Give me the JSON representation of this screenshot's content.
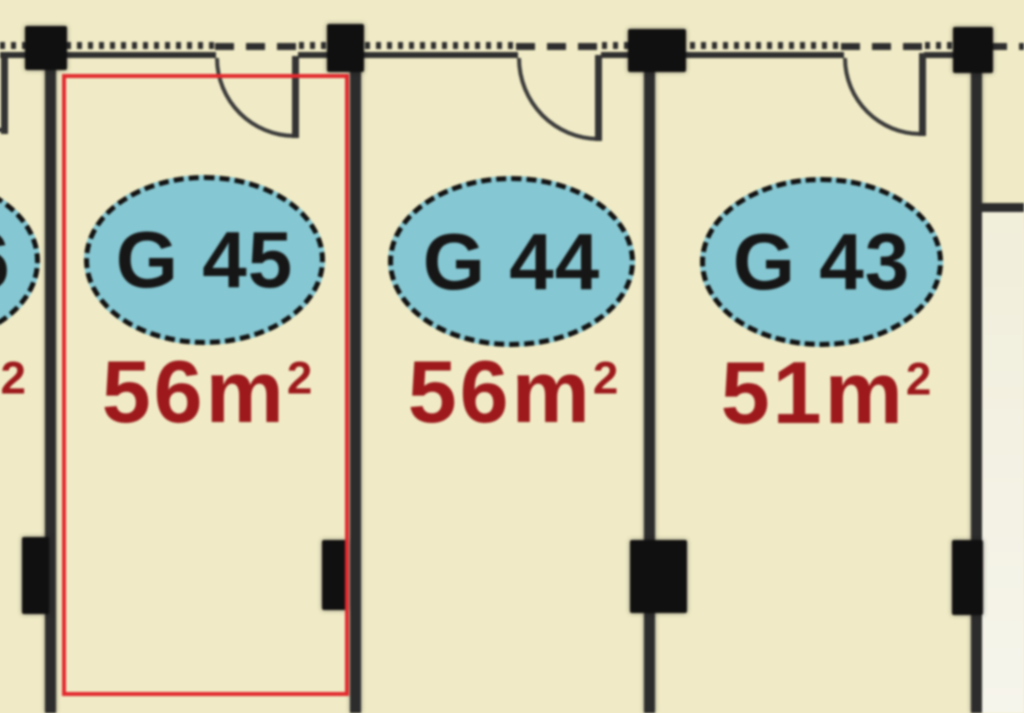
{
  "plan": {
    "title": "floor-plan-units",
    "colors": {
      "background": "#f0ebc6",
      "wall": "#2c2c2c",
      "column": "#101010",
      "ellipse_fill": "#85c7d2",
      "ellipse_border": "#121212",
      "unit_label_text": "#161616",
      "area_text": "#9d191c",
      "highlight_outline": "#e2292e"
    },
    "units": [
      {
        "label": "G 46",
        "area_value": "",
        "area_unit": "",
        "area_exponent": "2",
        "highlighted": false,
        "clipped": true
      },
      {
        "label": "G 45",
        "area_value": "56",
        "area_unit": "m",
        "area_exponent": "2",
        "highlighted": true,
        "clipped": false
      },
      {
        "label": "G 44",
        "area_value": "56",
        "area_unit": "m",
        "area_exponent": "2",
        "highlighted": false,
        "clipped": false
      },
      {
        "label": "G 43",
        "area_value": "51",
        "area_unit": "m",
        "area_exponent": "2",
        "highlighted": false,
        "clipped": false
      }
    ]
  }
}
